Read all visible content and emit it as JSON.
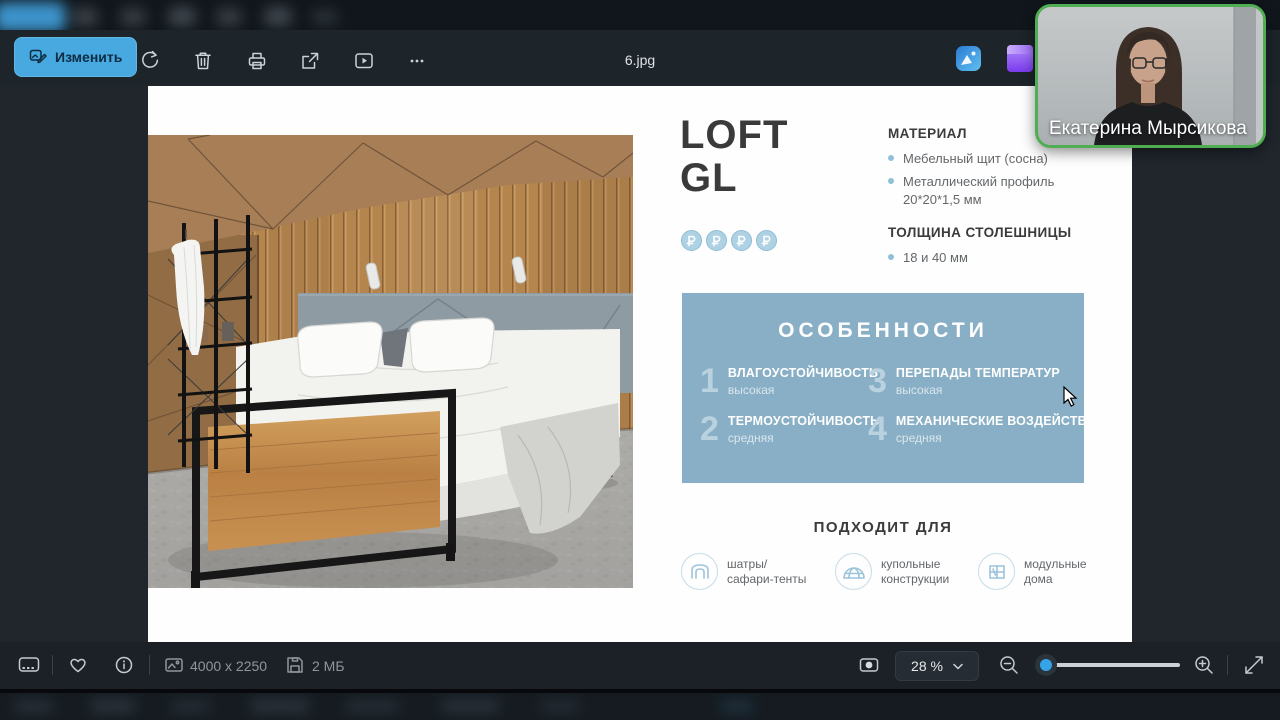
{
  "toolbar": {
    "edit_label": "Изменить",
    "filename": "6.jpg"
  },
  "statusbar": {
    "dimensions": "4000 x 2250",
    "filesize": "2 МБ",
    "zoom_level": "28 %"
  },
  "webcam": {
    "participant_name": "Екатерина Мырсикова"
  },
  "slide": {
    "title_line1": "LOFT",
    "title_line2": "GL",
    "price_symbol": "₽",
    "price_count": 4,
    "specs": [
      {
        "heading": "МАТЕРИАЛ",
        "items": [
          [
            "Мебельный щит (сосна)"
          ],
          [
            "Металлический профиль",
            "20*20*1,5 мм"
          ]
        ]
      },
      {
        "heading": "ТОЛЩИНА СТОЛЕШНИЦЫ",
        "items": [
          [
            "18 и 40 мм"
          ]
        ]
      }
    ],
    "features": {
      "heading": "ОСОБЕННОСТИ",
      "items": [
        {
          "num": "1",
          "title": "ВЛАГОУСТОЙЧИВОСТЬ",
          "value": "высокая"
        },
        {
          "num": "2",
          "title": "ТЕРМОУСТОЙЧИВОСТЬ",
          "value": "средняя"
        },
        {
          "num": "3",
          "title": "ПЕРЕПАДЫ ТЕМПЕРАТУР",
          "value": "высокая"
        },
        {
          "num": "4",
          "title": "МЕХАНИЧЕСКИЕ ВОЗДЕЙСТВИЯ",
          "value": "средняя"
        }
      ]
    },
    "suitable": {
      "heading": "ПОДХОДИТ ДЛЯ",
      "items": [
        {
          "icon": "tent-icon",
          "lines": [
            "шатры/",
            "сафари-тенты"
          ]
        },
        {
          "icon": "dome-icon",
          "lines": [
            "купольные",
            "конструкции"
          ]
        },
        {
          "icon": "module-house-icon",
          "lines": [
            "модульные",
            "дома"
          ]
        }
      ]
    }
  },
  "colors": {
    "accent_button": "#47a9e0",
    "features_box": "#88afc5",
    "webcam_border": "#4fae51",
    "slider_thumb": "#35a3e8",
    "price_icon": "#aed2e4"
  }
}
